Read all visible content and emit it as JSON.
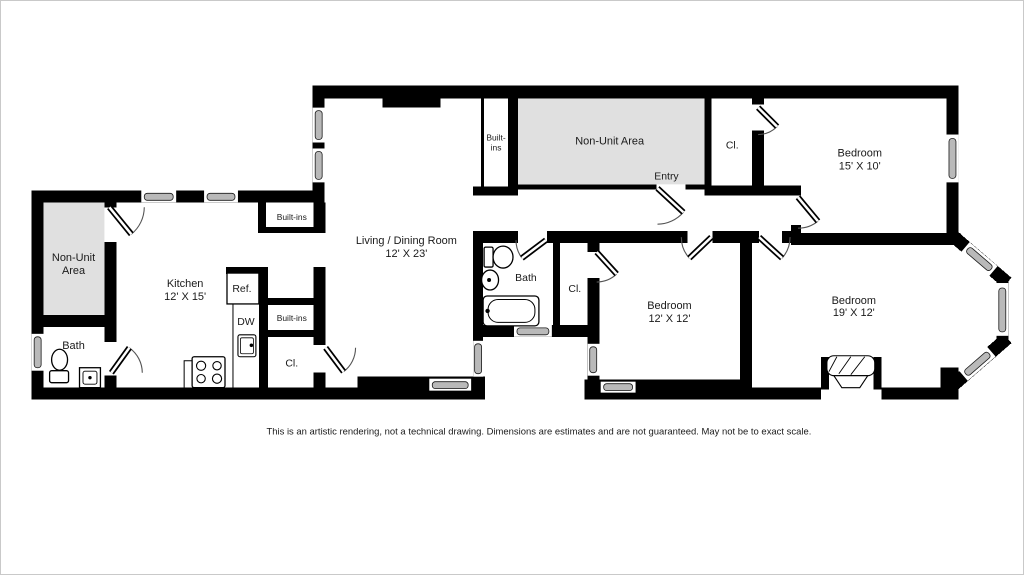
{
  "colors": {
    "wall": "#000000",
    "non_unit_fill": "#e0e0e0",
    "window_fill": "#b9b9b9",
    "background": "#ffffff",
    "text": "#1a1a1a"
  },
  "rooms": {
    "non_unit_left": {
      "line1": "Non-Unit",
      "line2": "Area"
    },
    "bath_left": {
      "label": "Bath"
    },
    "kitchen": {
      "name": "Kitchen",
      "dims": "12' X 15'",
      "fridge_label": "Ref.",
      "dishwasher_label": "DW"
    },
    "built_ins_kitchen_top": {
      "label": "Built-ins"
    },
    "built_ins_kitchen_mid": {
      "label": "Built-ins"
    },
    "closet_kitchen": {
      "label": "Cl."
    },
    "living_dining": {
      "name": "Living / Dining Room",
      "dims": "12' X 23'"
    },
    "built_ins_living": {
      "line1": "Built-",
      "line2": "ins"
    },
    "non_unit_top": {
      "label": "Non-Unit Area"
    },
    "entry": {
      "label": "Entry"
    },
    "closet_top": {
      "label": "Cl."
    },
    "bedroom_15x10": {
      "name": "Bedroom",
      "dims": "15' X 10'"
    },
    "bath_middle": {
      "label": "Bath"
    },
    "closet_middle": {
      "label": "Cl."
    },
    "bedroom_12x12": {
      "name": "Bedroom",
      "dims": "12' X 12'"
    },
    "bedroom_19x12": {
      "name": "Bedroom",
      "dims": "19' X 12'"
    }
  },
  "footer": {
    "disclaimer": "This is an artistic rendering, not a technical drawing. Dimensions are estimates and are not guaranteed. May not be to exact scale."
  }
}
